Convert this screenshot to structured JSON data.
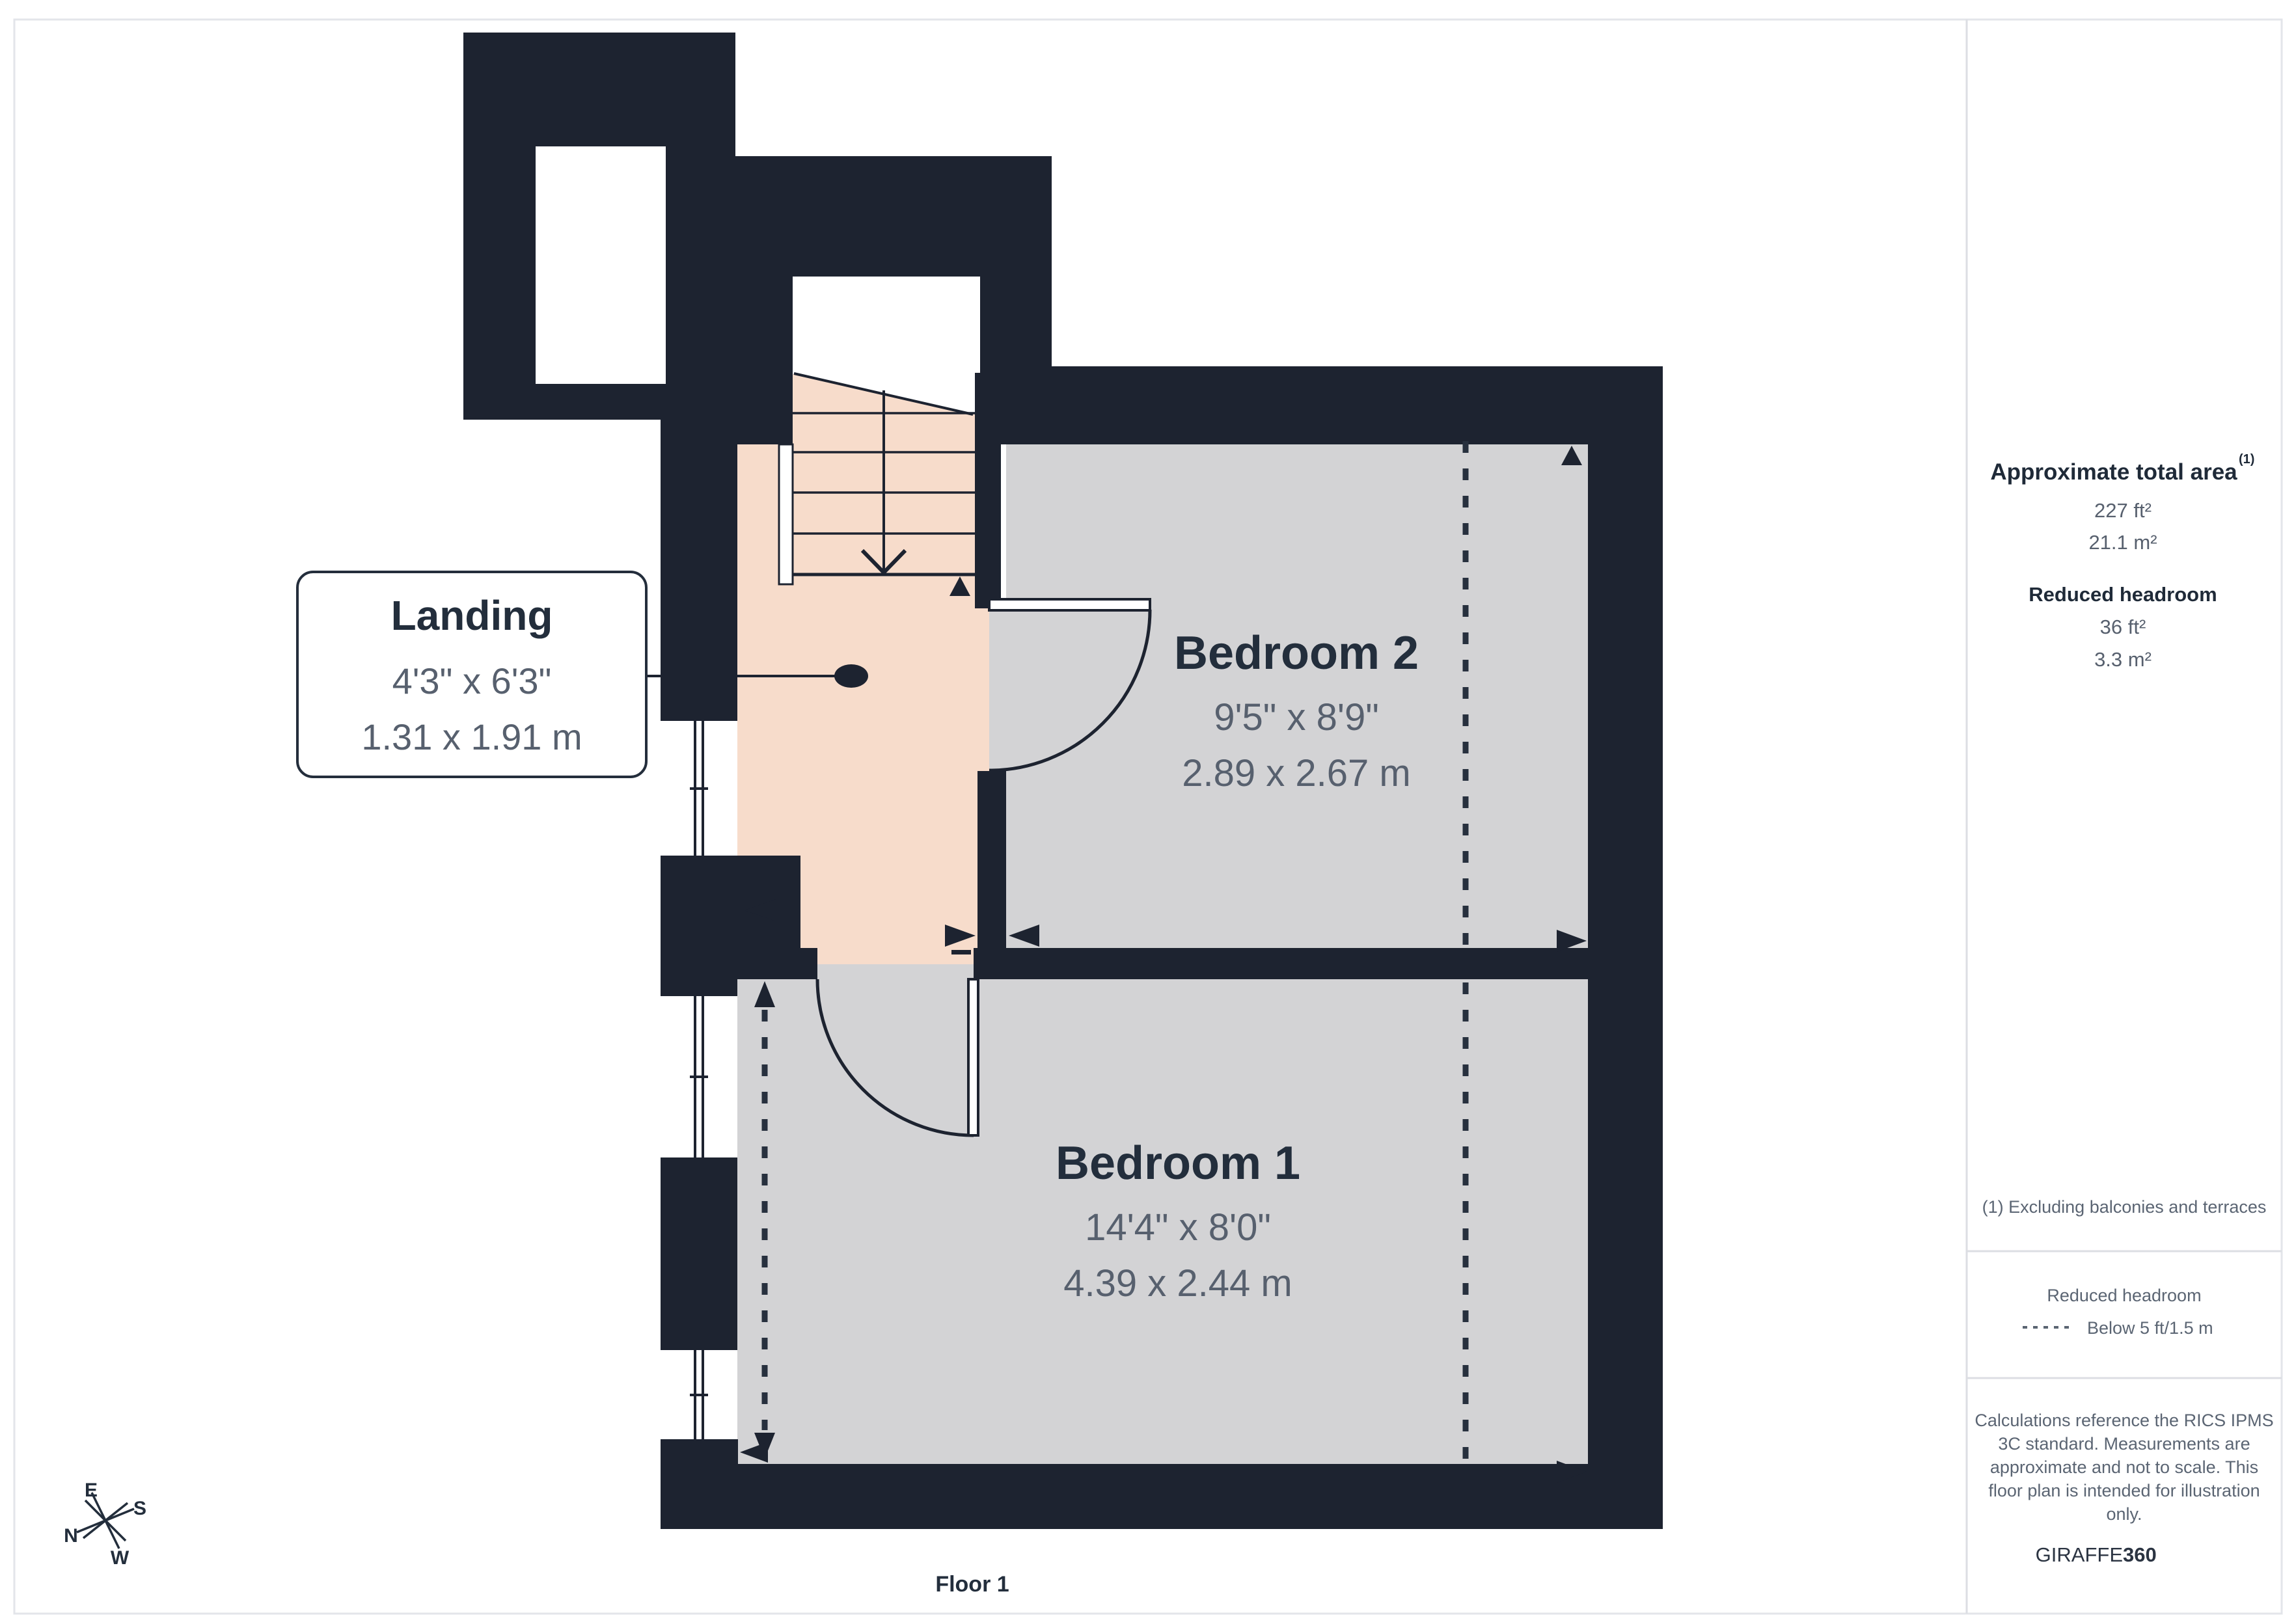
{
  "plan": {
    "floor_label": "Floor 1",
    "rooms": {
      "landing": {
        "name": "Landing",
        "dims_ft": "4'3\" x 6'3\"",
        "dims_m": "1.31 x 1.91 m"
      },
      "bedroom2": {
        "name": "Bedroom 2",
        "dims_ft": "9'5\" x 8'9\"",
        "dims_m": "2.89 x 2.67 m"
      },
      "bedroom1": {
        "name": "Bedroom 1",
        "dims_ft": "14'4\" x 8'0\"",
        "dims_m": "4.39 x 2.44 m"
      }
    },
    "compass": {
      "n": "N",
      "e": "E",
      "s": "S",
      "w": "W"
    }
  },
  "sidebar": {
    "total_area": {
      "heading": "Approximate total area",
      "footnote_marker": "(1)",
      "value_ft": "227 ft²",
      "value_m": "21.1 m²"
    },
    "reduced_headroom": {
      "heading": "Reduced headroom",
      "value_ft": "36 ft²",
      "value_m": "3.3 m²"
    },
    "footnote": "(1) Excluding balconies and terraces",
    "legend": {
      "title": "Reduced headroom",
      "item": "Below 5 ft/1.5 m"
    },
    "disclaimer": {
      "lines": [
        "Calculations reference the RICS IPMS",
        "3C standard. Measurements are",
        "approximate and not to scale. This",
        "floor plan is intended for illustration",
        "only."
      ]
    },
    "brand": {
      "name": "GIRAFFE",
      "suffix": "360"
    }
  },
  "colors": {
    "wall": "#1d2330",
    "landing_floor": "#f7dccb",
    "room_floor": "#d3d3d5",
    "title_text": "#232e3c",
    "dim_text": "#57606e",
    "muted_text": "#5b6573",
    "frame": "#e3e5ea"
  }
}
